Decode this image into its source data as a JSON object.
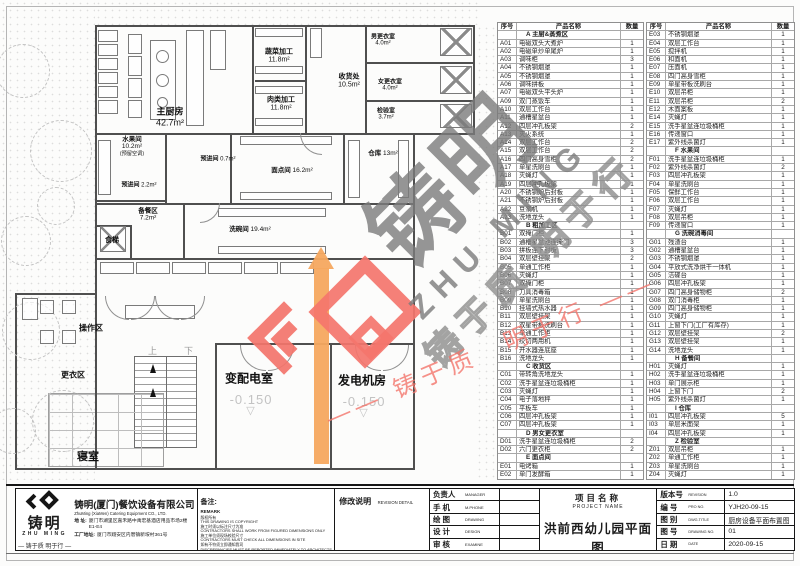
{
  "colors": {
    "accent_red": "#f4756c",
    "accent_orange": "#f5a85f",
    "watermark_gray": "#7c7c7c",
    "line": "#4f4f4f"
  },
  "plan": {
    "rooms": [
      {
        "label": "主厨房",
        "area": "42.7m²",
        "x": 170,
        "y": 116,
        "fs": 9,
        "inline": false
      },
      {
        "label": "蔬菜加工",
        "area": "11.8m²",
        "x": 279,
        "y": 55,
        "fs": 7,
        "inline": false
      },
      {
        "label": "肉类加工",
        "area": "11.8m²",
        "x": 281,
        "y": 103,
        "fs": 7,
        "inline": false
      },
      {
        "label": "收货处",
        "area": "10.5m²",
        "x": 349,
        "y": 80,
        "fs": 7,
        "inline": false
      },
      {
        "label": "男更衣室",
        "area": "4.0m²",
        "x": 383,
        "y": 39,
        "fs": 6,
        "inline": false
      },
      {
        "label": "女更衣室",
        "area": "4.0m²",
        "x": 390,
        "y": 84,
        "fs": 6,
        "inline": false
      },
      {
        "label": "检验室",
        "area": "3.7m²",
        "x": 386,
        "y": 113,
        "fs": 6,
        "inline": false
      },
      {
        "label": "水果间",
        "area": "10.2m²",
        "x": 132,
        "y": 145,
        "fs": 6.5,
        "inline": false,
        "note": "(预留空调)"
      },
      {
        "label": "预进间",
        "area": "0.7m²",
        "x": 218,
        "y": 158,
        "fs": 6,
        "inline": true
      },
      {
        "label": "预进间",
        "area": "2.2m²",
        "x": 139,
        "y": 184,
        "fs": 6,
        "inline": true
      },
      {
        "label": "面点间",
        "area": "16.2m²",
        "x": 292,
        "y": 169,
        "fs": 6.5,
        "inline": true
      },
      {
        "label": "仓库",
        "area": "13m²",
        "x": 383,
        "y": 152,
        "fs": 6.5,
        "inline": true
      },
      {
        "label": "备餐区",
        "area": "7.2m²",
        "x": 148,
        "y": 213,
        "fs": 6.5,
        "inline": false
      },
      {
        "label": "洗碗间",
        "area": "19.4m²",
        "x": 250,
        "y": 228,
        "fs": 6.5,
        "inline": true
      },
      {
        "label": "食梯",
        "area": "",
        "x": 112,
        "y": 240,
        "fs": 7,
        "inline": false
      },
      {
        "label": "操作区",
        "area": "",
        "x": 91,
        "y": 328,
        "fs": 8,
        "inline": false
      },
      {
        "label": "更衣区",
        "area": "",
        "x": 73,
        "y": 375,
        "fs": 8,
        "inline": false
      },
      {
        "label": "寝室",
        "area": "",
        "x": 88,
        "y": 456,
        "fs": 11,
        "inline": false
      },
      {
        "label": "变配电室",
        "area": "",
        "x": 249,
        "y": 378,
        "fs": 12,
        "inline": false
      },
      {
        "label": "发电机房",
        "area": "",
        "x": 362,
        "y": 380,
        "fs": 12,
        "inline": false
      }
    ],
    "elevations": [
      {
        "value": "-0.150",
        "tri": "▽",
        "x": 251,
        "y": 392
      },
      {
        "value": "-0.150",
        "tri": "▽",
        "x": 364,
        "y": 394
      }
    ],
    "stair_labels": {
      "up": "上",
      "down": "下"
    },
    "walls": [
      [
        95,
        25,
        380,
        2
      ],
      [
        95,
        25,
        2,
        445
      ],
      [
        473,
        25,
        2,
        110
      ],
      [
        413,
        133,
        62,
        1.5
      ],
      [
        413,
        133,
        2,
        337
      ],
      [
        15,
        468,
        400,
        2
      ],
      [
        15,
        293,
        2,
        177
      ],
      [
        15,
        293,
        82,
        1.5
      ],
      [
        252,
        25,
        1.5,
        110
      ],
      [
        305,
        25,
        1.5,
        110
      ],
      [
        365,
        25,
        1.5,
        110
      ],
      [
        255,
        80,
        50,
        1.5
      ],
      [
        365,
        62,
        110,
        1.5
      ],
      [
        365,
        100,
        110,
        1.5
      ],
      [
        95,
        133,
        320,
        1.5
      ],
      [
        165,
        133,
        1.5,
        70
      ],
      [
        95,
        200,
        72,
        1.5
      ],
      [
        230,
        133,
        1.5,
        70
      ],
      [
        343,
        133,
        1.5,
        70
      ],
      [
        95,
        203,
        320,
        1.5
      ],
      [
        95,
        258,
        320,
        1.5
      ],
      [
        183,
        203,
        1.5,
        55
      ],
      [
        130,
        225,
        1.5,
        33
      ],
      [
        95,
        225,
        35,
        1.5
      ],
      [
        215,
        343,
        200,
        2
      ],
      [
        330,
        343,
        2,
        127
      ],
      [
        215,
        343,
        2,
        127
      ]
    ],
    "fixtures": [
      [
        98,
        30,
        20,
        12,
        "r"
      ],
      [
        98,
        44,
        20,
        12,
        "r"
      ],
      [
        98,
        58,
        20,
        12,
        "r"
      ],
      [
        98,
        72,
        20,
        12,
        "r"
      ],
      [
        98,
        86,
        20,
        12,
        "r"
      ],
      [
        98,
        100,
        20,
        14,
        "r"
      ],
      [
        128,
        34,
        14,
        20,
        "r"
      ],
      [
        128,
        56,
        14,
        20,
        "r"
      ],
      [
        128,
        78,
        14,
        20,
        "r"
      ],
      [
        128,
        100,
        14,
        18,
        "r"
      ],
      [
        150,
        40,
        26,
        80,
        "r"
      ],
      [
        156,
        50,
        13,
        13,
        "c"
      ],
      [
        156,
        74,
        13,
        13,
        "c"
      ],
      [
        157,
        97,
        11,
        11,
        "c"
      ],
      [
        186,
        30,
        18,
        96,
        "r"
      ],
      [
        210,
        30,
        16,
        40,
        "r"
      ],
      [
        255,
        28,
        48,
        9,
        "r"
      ],
      [
        255,
        66,
        48,
        8,
        "r"
      ],
      [
        255,
        86,
        48,
        8,
        "r"
      ],
      [
        255,
        118,
        48,
        8,
        "r"
      ],
      [
        310,
        28,
        12,
        30,
        "r"
      ],
      [
        440,
        28,
        32,
        28,
        "x"
      ],
      [
        440,
        66,
        32,
        28,
        "x"
      ],
      [
        440,
        104,
        32,
        24,
        "x"
      ],
      [
        98,
        140,
        13,
        55,
        "r"
      ],
      [
        240,
        136,
        92,
        9,
        "r"
      ],
      [
        240,
        192,
        92,
        8,
        "r"
      ],
      [
        348,
        140,
        12,
        58,
        "r"
      ],
      [
        398,
        140,
        11,
        58,
        "r"
      ],
      [
        218,
        208,
        108,
        9,
        "r"
      ],
      [
        218,
        246,
        108,
        8,
        "r"
      ],
      [
        100,
        262,
        34,
        12,
        "r"
      ],
      [
        136,
        262,
        34,
        12,
        "r"
      ],
      [
        172,
        262,
        34,
        12,
        "r"
      ],
      [
        208,
        262,
        34,
        12,
        "r"
      ],
      [
        244,
        262,
        34,
        12,
        "r"
      ],
      [
        280,
        262,
        34,
        12,
        "r"
      ],
      [
        40,
        300,
        14,
        14,
        "r"
      ],
      [
        62,
        300,
        14,
        14,
        "r"
      ],
      [
        40,
        330,
        14,
        14,
        "r"
      ],
      [
        62,
        330,
        14,
        14,
        "r"
      ],
      [
        22,
        298,
        16,
        22,
        "r"
      ],
      [
        100,
        226,
        26,
        26,
        "x"
      ],
      [
        125,
        305,
        70,
        14,
        "r"
      ]
    ],
    "doors": [
      [
        105,
        296,
        24,
        0
      ],
      [
        131,
        296,
        24,
        1
      ],
      [
        155,
        296,
        24,
        0
      ],
      [
        181,
        296,
        24,
        1
      ],
      [
        240,
        345,
        26,
        0
      ],
      [
        268,
        345,
        26,
        1
      ],
      [
        355,
        345,
        26,
        0
      ],
      [
        383,
        345,
        26,
        1
      ],
      [
        300,
        133,
        22,
        0
      ],
      [
        200,
        203,
        20,
        1
      ]
    ],
    "trees": [
      [
        22,
        70,
        26
      ],
      [
        60,
        150,
        30
      ],
      [
        25,
        240,
        24
      ],
      [
        55,
        205,
        18
      ],
      [
        30,
        330,
        28
      ],
      [
        62,
        420,
        30
      ],
      [
        12,
        430,
        22
      ]
    ]
  },
  "equipment_tables": {
    "headers": {
      "no": "序号",
      "name": "产品名称",
      "qty": "数量"
    },
    "left": [
      {
        "section": "A 主厨&蒸煮区"
      },
      [
        "A01",
        "电磁双头大煮炉",
        "1"
      ],
      [
        "A02",
        "电磁单炒单尾炉",
        "1"
      ],
      [
        "A03",
        "调味柜",
        "3"
      ],
      [
        "A04",
        "不锈钢烟罩",
        "1"
      ],
      [
        "A05",
        "不锈钢烟罩",
        "1"
      ],
      [
        "A06",
        "调味拼板",
        "1"
      ],
      [
        "A07",
        "电磁双头平头炉",
        "1"
      ],
      [
        "A09",
        "双门蒸饭车",
        "1"
      ],
      [
        "A10",
        "双层工作台",
        "1"
      ],
      [
        "A11",
        "通槽星盆台",
        "1"
      ],
      [
        "A12",
        "四层冲孔板架",
        "2"
      ],
      [
        "A13",
        "灭火系统",
        "1"
      ],
      [
        "A14",
        "双层工作台",
        "2"
      ],
      [
        "A15",
        "双层工作台",
        "2"
      ],
      [
        "A16",
        "四门高身雪柜",
        "2"
      ],
      [
        "A17",
        "单星洗刷台",
        "1"
      ],
      [
        "A18",
        "灭蝇灯",
        "1"
      ],
      [
        "A19",
        "四层冲孔板架",
        "1"
      ],
      [
        "A20",
        "不锈钢炉后封板",
        "1"
      ],
      [
        "A21",
        "不锈钢炉后封板",
        "1"
      ],
      [
        "A22",
        "豆浆机",
        "1"
      ],
      [
        "A23",
        "洗地龙头",
        "1"
      ],
      {
        "section": "B 粗加工区"
      },
      [
        "B01",
        "双掩门柜",
        "1"
      ],
      [
        "B02",
        "通槽星盆池连掩门",
        "3"
      ],
      [
        "B03",
        "拼板连下封板",
        "3"
      ],
      [
        "B04",
        "双层壁挂架",
        "2"
      ],
      [
        "B05",
        "单通工作柜",
        "1"
      ],
      [
        "B06",
        "灭蝇灯",
        "1"
      ],
      [
        "B07",
        "双掩门柜",
        "1"
      ],
      [
        "B08",
        "刀具消毒箱",
        "1"
      ],
      [
        "B09",
        "单星洗刷台",
        "1"
      ],
      [
        "B10",
        "挂墙式热水器",
        "1"
      ],
      [
        "B11",
        "双层壁挂架",
        "1"
      ],
      [
        "B12",
        "双星带板洗刷台",
        "1"
      ],
      [
        "B13",
        "单通工作柜",
        "1"
      ],
      [
        "B14",
        "绞切两用机",
        "1"
      ],
      [
        "B15",
        "开水器连底座",
        "1"
      ],
      [
        "B16",
        "洗地龙头",
        "1"
      ],
      {
        "section": "C 收货区"
      },
      [
        "C01",
        "带转角洗地龙头",
        "1"
      ],
      [
        "C02",
        "洗手星盆连垃圾桶柜",
        "1"
      ],
      [
        "C03",
        "灭蝇灯",
        "1"
      ],
      [
        "C04",
        "电子落地秤",
        "1"
      ],
      [
        "C05",
        "平板车",
        "1"
      ],
      [
        "C06",
        "四层冲孔板架",
        "1"
      ],
      [
        "C07",
        "四层冲孔板架",
        "1"
      ],
      {
        "section": "D 男女更衣室"
      },
      [
        "D01",
        "洗手星盆连垃圾桶柜",
        "2"
      ],
      [
        "D02",
        "六门更衣柜",
        "2"
      ],
      {
        "section": "E 面点间"
      },
      [
        "E01",
        "电烤箱",
        "1"
      ],
      [
        "E02",
        "单门发酵箱",
        "1"
      ]
    ],
    "right": [
      [
        "E03",
        "不锈钢烟罩",
        "1"
      ],
      [
        "E04",
        "双层工作台",
        "1"
      ],
      [
        "E05",
        "搅拌机",
        "1"
      ],
      [
        "E06",
        "和面机",
        "1"
      ],
      [
        "E07",
        "压面机",
        "1"
      ],
      [
        "E08",
        "四门高身雪柜",
        "1"
      ],
      [
        "E09",
        "单星带板洗刷台",
        "1"
      ],
      [
        "E10",
        "双层吊柜",
        "1"
      ],
      [
        "E11",
        "双层吊柜",
        "2"
      ],
      [
        "E12",
        "木面案板",
        "1"
      ],
      [
        "E14",
        "灭蝇灯",
        "1"
      ],
      [
        "E15",
        "洗手星盆连垃圾桶柜",
        "1"
      ],
      [
        "E16",
        "传递窗口",
        "1"
      ],
      [
        "E17",
        "紫外线杀菌灯",
        "1"
      ],
      {
        "section": "F 水果间"
      },
      [
        "F01",
        "洗手星盆连垃圾桶柜",
        "1"
      ],
      [
        "F02",
        "紫外线杀菌灯",
        "2"
      ],
      [
        "F03",
        "四层冲孔板架",
        "1"
      ],
      [
        "F04",
        "单星洗刷台",
        "1"
      ],
      [
        "F05",
        "保鲜工作台",
        "1"
      ],
      [
        "F06",
        "双层工作台",
        "1"
      ],
      [
        "F07",
        "灭蝇灯",
        "1"
      ],
      [
        "F08",
        "双层吊柜",
        "1"
      ],
      [
        "F09",
        "传递窗口",
        "1"
      ],
      {
        "section": "G 洗碗消毒间"
      },
      [
        "G01",
        "残渣台",
        "1"
      ],
      [
        "G02",
        "通槽星盆台",
        "1"
      ],
      [
        "G03",
        "不锈钢烟罩",
        "1"
      ],
      [
        "G04",
        "平放式洗净烘干一体机",
        "1"
      ],
      [
        "G05",
        "洁碟台",
        "1"
      ],
      [
        "G06",
        "四层冲孔板架",
        "1"
      ],
      [
        "G07",
        "四门高身储物柜",
        "2"
      ],
      [
        "G08",
        "双门消毒柜",
        "1"
      ],
      [
        "G09",
        "四门高身储物柜",
        "1"
      ],
      [
        "G10",
        "灭蝇灯",
        "1"
      ],
      [
        "G11",
        "上窗下门(工厂有库存)",
        "1"
      ],
      [
        "G12",
        "双层壁挂架",
        "2"
      ],
      [
        "G13",
        "双层壁挂架",
        "1"
      ],
      [
        "G14",
        "洗地龙头",
        "1"
      ],
      {
        "section": "H 备餐间"
      },
      [
        "H01",
        "灭蝇灯",
        "1"
      ],
      [
        "H02",
        "洗手星盆连垃圾桶柜",
        "1"
      ],
      [
        "H03",
        "单门展示柜",
        "1"
      ],
      [
        "H04",
        "上窗下门",
        "2"
      ],
      [
        "H05",
        "紫外线杀菌灯",
        "1"
      ],
      {
        "section": "I 仓库"
      },
      [
        "I01",
        "四层冲孔板架",
        "5"
      ],
      [
        "I03",
        "单层米面架",
        "1"
      ],
      [
        "I04",
        "四层冲孔板架",
        "1"
      ],
      {
        "section": "Z 检验室"
      },
      [
        "Z01",
        "双层吊柜",
        "1"
      ],
      [
        "Z02",
        "单通工作柜",
        "1"
      ],
      [
        "Z03",
        "单星洗刷台",
        "1"
      ],
      [
        "Z04",
        "灭蝇灯",
        "1"
      ]
    ]
  },
  "watermark": {
    "zh": "铸明",
    "en": "ZHU MING",
    "outline": "铸于质 明于行",
    "tagline": "—— 铸于质　明于行 ——"
  },
  "title_block": {
    "logo": {
      "zh": "铸明",
      "en": "ZHU MING",
      "tagline": "— 铸于质 明于行 —"
    },
    "company": {
      "name": "铸明(厦门)餐饮设备有限公司",
      "name_en": "ZhuMing (XiaMen) Catering Equipment CO., LTD.",
      "addr_label": "地  址:",
      "addr": "厦门市湖里区嘉禾路中禹宏基酒店用品市场2楼E1-E4",
      "factory_label": "工厂地址:",
      "factory": "厦门市翔安区内厝镇新垵村361号"
    },
    "remark": {
      "zh": "备注:",
      "en": "REMARK",
      "lines": [
        "版权所有",
        "THIS DRAWING IS COPYRIGHT",
        "施工时须以标注尺寸为准",
        "CONTRACTORS SHALL WORK FROM FIGURED DIMENSIONS ONLY",
        "施工单位须现场校验尺寸",
        "CONTRACTORS MUST CHECK ALL DIMENSIONS IN SITE",
        "如有不符须立即通知我司",
        "DISCREPANCIES MUST BE REPORTED IMMEDIATELY TO ARCHITECTS"
      ]
    },
    "revision": {
      "zh": "修改说明",
      "en": "REVISION DETAIL"
    },
    "signers": [
      {
        "zh": "负责人",
        "en": "MANAGER",
        "value": ""
      },
      {
        "zh": "手  机",
        "en": "M.PHONE",
        "value": ""
      },
      {
        "zh": "绘  图",
        "en": "DRAWING",
        "value": ""
      },
      {
        "zh": "设  计",
        "en": "DESIGN",
        "value": ""
      },
      {
        "zh": "审  核",
        "en": "EXAMINE",
        "value": ""
      }
    ],
    "project": {
      "zh": "项目名称",
      "en": "PROJECT NAME",
      "value": "洪前西幼儿园平面图"
    },
    "info": [
      {
        "zh": "版本号",
        "en": "REVISION",
        "value": "1.0"
      },
      {
        "zh": "编  号",
        "en": "PRO NO.",
        "value": "YJH20-09-15"
      },
      {
        "zh": "图  别",
        "en": "DWG.TITLE",
        "value": "厨房设备平面布置图"
      },
      {
        "zh": "图  号",
        "en": "DRAWING NO.",
        "value": "01"
      },
      {
        "zh": "日  期",
        "en": "DATE",
        "value": "2020-09-15"
      }
    ]
  }
}
